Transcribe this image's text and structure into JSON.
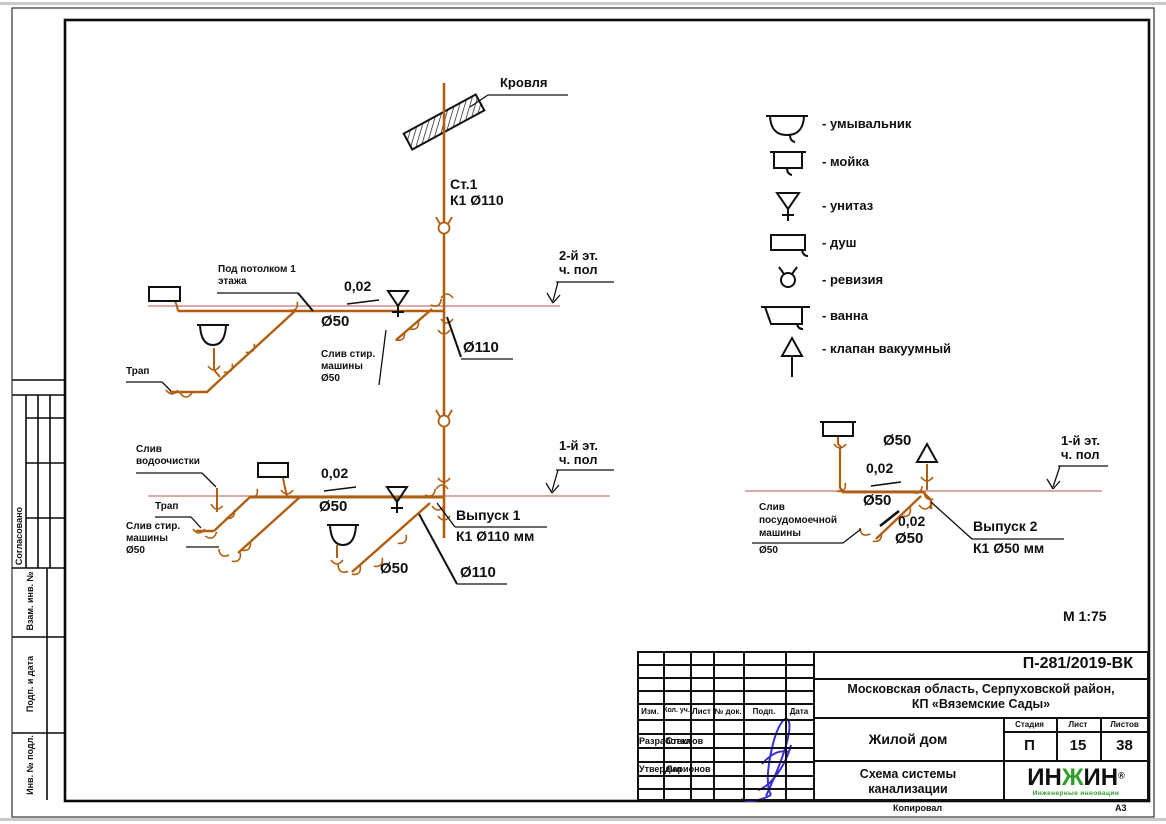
{
  "page": {
    "scale_label": "М 1:75",
    "copied_label": "Копировал",
    "format_label": "А3"
  },
  "side_stamp": {
    "soglasovano": "Согласовано",
    "vzam": "Взам. инв. №",
    "podp_data": "Подп. и дата",
    "inv_podl": "Инв. № подл."
  },
  "diagram": {
    "roof": "Кровля",
    "stack_line1": "Ст.1",
    "stack_line2": "К1 Ø110",
    "floor2_line1": "2-й эт.",
    "floor2_line2": "ч. пол",
    "floor1_line1": "1-й эт.",
    "floor1_line2": "ч. пол",
    "under_ceiling_line1": "Под потолком 1",
    "under_ceiling_line2": "этажа",
    "slope": "0,02",
    "d50": "Ø50",
    "d110": "Ø110",
    "trap": "Трап",
    "washer_line1": "Слив стир.",
    "washer_line2": "машины",
    "washer_line3": "Ø50",
    "water_line1": "Слив",
    "water_line2": "водоочистки",
    "dishwasher_line1": "Слив",
    "dishwasher_line2": "посудомоечной",
    "dishwasher_line3": "машины",
    "dishwasher_line4": "Ø50",
    "outlet1_line1": "Выпуск 1",
    "outlet1_line2": "К1 Ø110 мм",
    "outlet2_line1": "Выпуск 2",
    "outlet2_line2": "К1 Ø50 мм"
  },
  "legend": {
    "items": [
      {
        "icon": "washbasin-icon",
        "label": "- умывальник"
      },
      {
        "icon": "sink-icon",
        "label": "- мойка"
      },
      {
        "icon": "toilet-icon",
        "label": "- унитаз"
      },
      {
        "icon": "shower-icon",
        "label": "- душ"
      },
      {
        "icon": "revision-icon",
        "label": "- ревизия"
      },
      {
        "icon": "bath-icon",
        "label": "- ванна"
      },
      {
        "icon": "vacuum-valve-icon",
        "label": "- клапан вакуумный"
      }
    ]
  },
  "title_block": {
    "doc_number": "П-281/2019-ВК",
    "location_line1": "Московская область, Серпуховской район,",
    "location_line2": "КП «Вяземские Сады»",
    "object_name": "Жилой дом",
    "stage_header": "Стадия",
    "sheet_header": "Лист",
    "sheets_header": "Листов",
    "stage": "П",
    "sheet_num": "15",
    "sheets_total": "38",
    "title_line1": "Схема системы",
    "title_line2": "канализации",
    "col_izm": "Изм.",
    "col_kol": "Кол. уч.",
    "col_list": "Лист",
    "col_ndok": "№ док.",
    "col_podp": "Подп.",
    "col_data": "Дата",
    "row1_role": "Разработал",
    "row1_name": "Стеклов",
    "row2_role": "Утвердил",
    "row2_name": "Ларионов",
    "logo_part1": "ИН",
    "logo_part2": "Ж",
    "logo_part3": "ИН",
    "logo_reg": "®",
    "logo_sub": "Инженерные инновации"
  },
  "colors": {
    "pipe": "#b05f10",
    "floor_line": "#c47878",
    "signature": "#3b2fd0",
    "logo_green": "#2f9e2b"
  }
}
